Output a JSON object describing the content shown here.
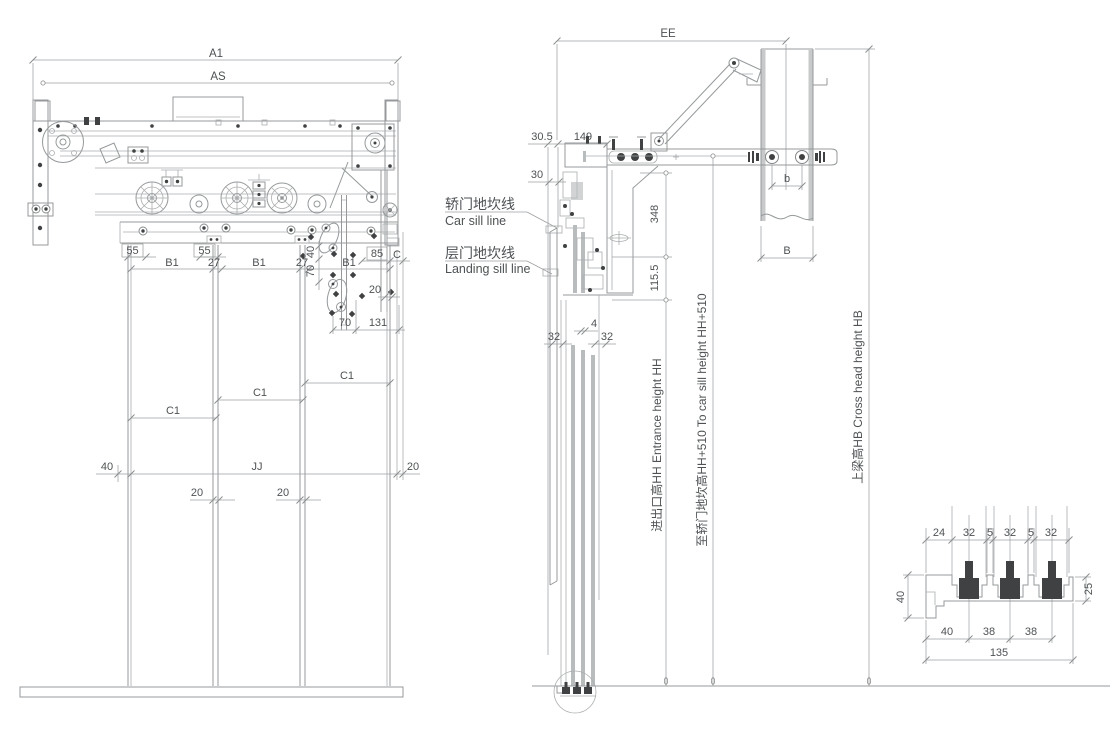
{
  "front_view": {
    "dim_a1": "A1",
    "dim_as": "AS",
    "dim_55": "55",
    "dim_b1": "B1",
    "dim_27": "27",
    "dim_40_rot": "40",
    "dim_70_rot": "70",
    "dim_85": "85",
    "dim_c": "C",
    "dim_20": "20",
    "dim_70": "70",
    "dim_131": "131",
    "dim_c1": "C1",
    "dim_40": "40",
    "dim_jj": "JJ"
  },
  "side_view": {
    "dim_ee": "EE",
    "dim_30_5": "30.5",
    "dim_149": "149",
    "dim_30": "30",
    "dim_348": "348",
    "dim_115_5": "115.5",
    "dim_4": "4",
    "dim_32": "32",
    "dim_b_small": "b",
    "dim_b_big": "B",
    "car_sill_cn": "轿门地坎线",
    "car_sill_en": "Car sill line",
    "landing_sill_cn": "层门地坎线",
    "landing_sill_en": "Landing sill line",
    "entrance_height_label": "进出口高HH Entrance height HH",
    "to_car_sill_label": "至轿门地坎高HH+510 To car sill height HH+510",
    "cross_head_label": "上梁高HB Cross head height HB"
  },
  "sill_detail": {
    "dim_24": "24",
    "dim_32": "32",
    "dim_5": "5",
    "dim_40_left": "40",
    "dim_25": "25",
    "dim_40_bottom": "40",
    "dim_38": "38",
    "dim_135": "135"
  }
}
